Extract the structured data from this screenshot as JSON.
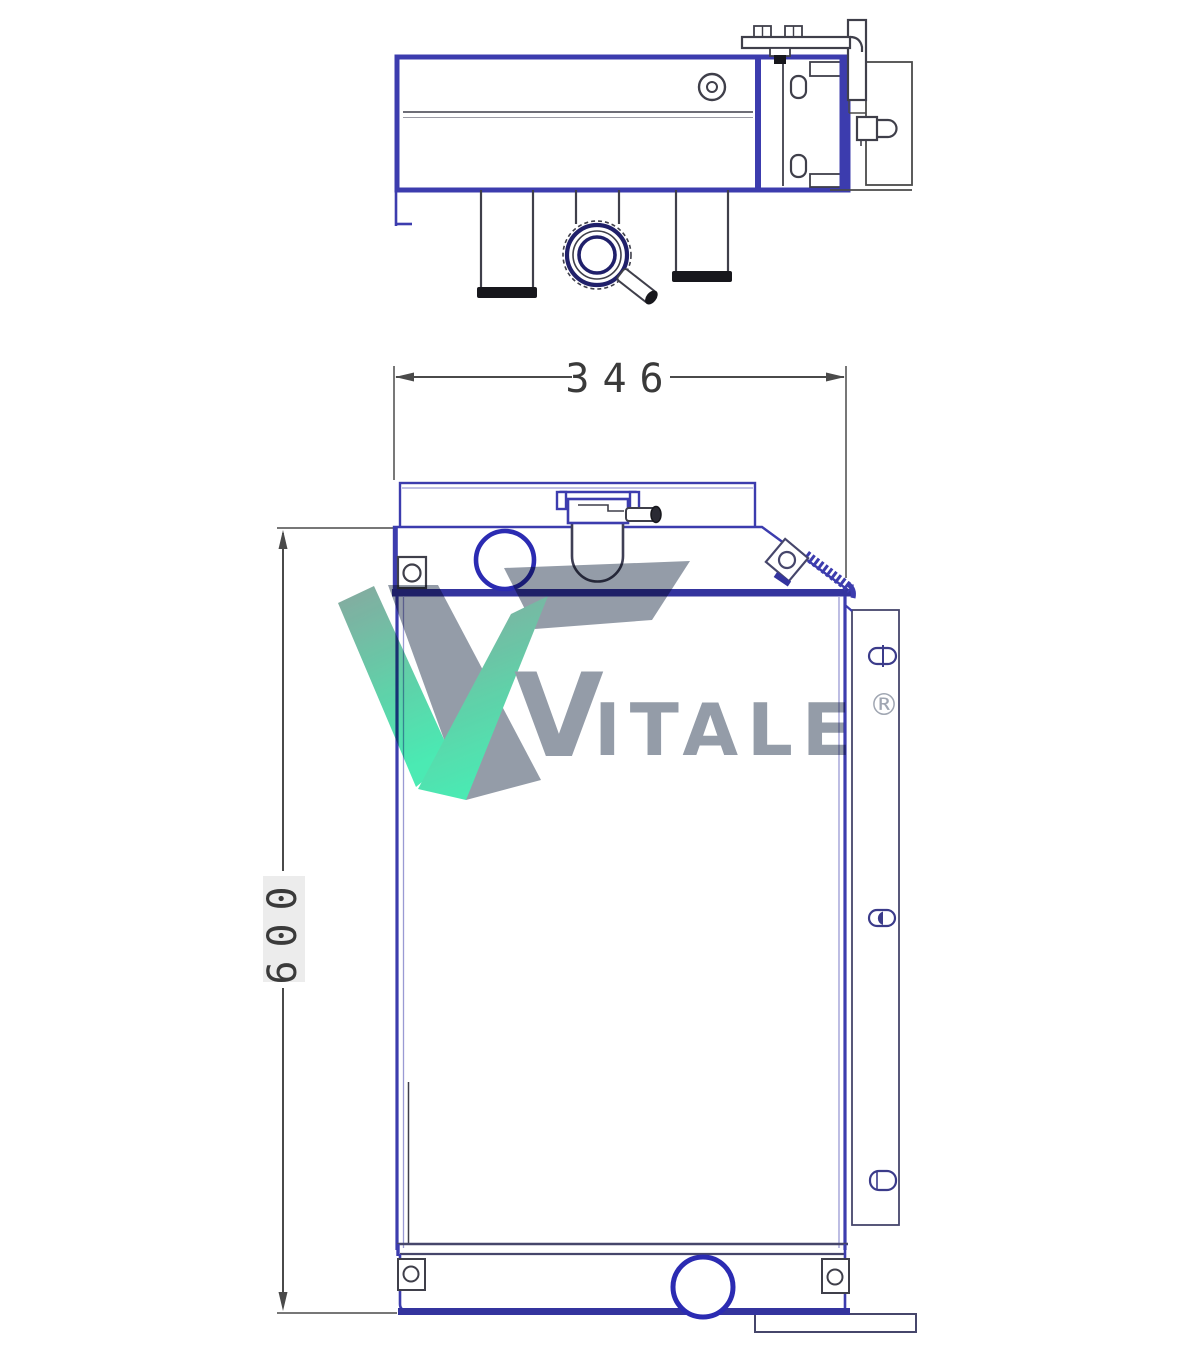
{
  "dimensions": {
    "width": "346",
    "height": "600"
  },
  "logo": {
    "v": "V",
    "rest": "ITALE",
    "registered": "®"
  },
  "colors": {
    "line_blue": "#3c3cae",
    "line_bold_blue": "#2b2bb2",
    "band_navy": "#34349e",
    "line_dark": "#3f3f4a",
    "panel_navy": "#46466b",
    "dim_gray": "#4a4a4a",
    "logo_gray": "#8d96a3",
    "logo_green_top": "#7fa399",
    "logo_green_mid": "#55cfa4",
    "logo_green_bottom": "#3fe9ae"
  }
}
